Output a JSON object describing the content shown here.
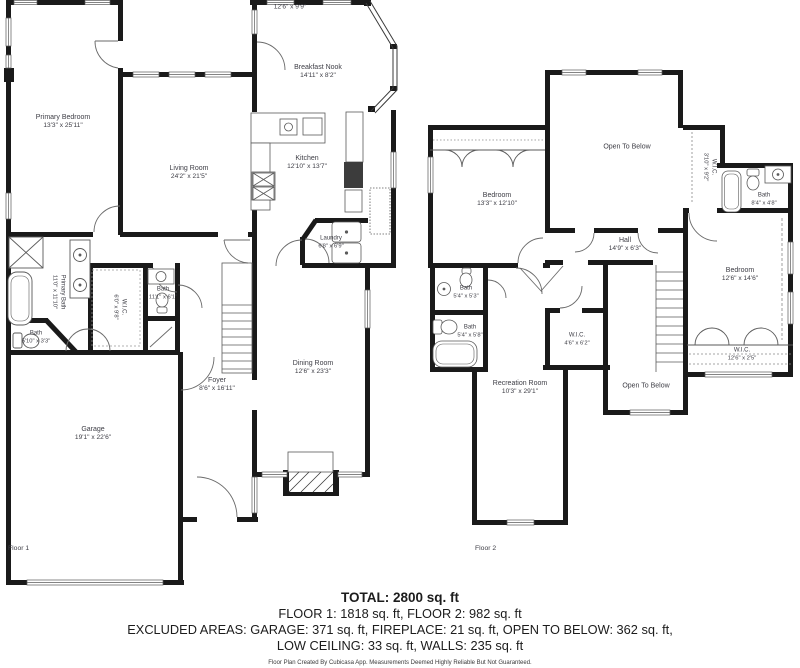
{
  "colors": {
    "wall": "#1a1a1a",
    "thin": "#5a5a5a",
    "label_text": "#3d3d45"
  },
  "floor1": {
    "label": "Floor 1",
    "rooms": [
      {
        "id": "unnamed-top",
        "name": "",
        "dims": "12'6\" x 9'9\""
      },
      {
        "id": "primary-bedroom",
        "name": "Primary Bedroom",
        "dims": "13'3\" x 25'11\""
      },
      {
        "id": "living-room",
        "name": "Living Room",
        "dims": "24'2\" x 21'5\""
      },
      {
        "id": "breakfast-nook",
        "name": "Breakfast Nook",
        "dims": "14'11\" x 8'2\""
      },
      {
        "id": "kitchen",
        "name": "Kitchen",
        "dims": "12'10\" x 13'7\""
      },
      {
        "id": "laundry",
        "name": "Laundry",
        "dims": "6'8\" x 6'9\""
      },
      {
        "id": "primary-bath",
        "name": "Primary Bath",
        "dims": "11'0\" x 11'10\""
      },
      {
        "id": "wic",
        "name": "W.I.C.",
        "dims": "6'0\" x 9'8\""
      },
      {
        "id": "bath-center",
        "name": "Bath",
        "dims": "11'1\" x 6'1\""
      },
      {
        "id": "bath-small",
        "name": "Bath",
        "dims": "5'10\" x 3'3\""
      },
      {
        "id": "foyer",
        "name": "Foyer",
        "dims": "8'6\" x 16'11\""
      },
      {
        "id": "garage",
        "name": "Garage",
        "dims": "19'1\" x 22'6\""
      },
      {
        "id": "dining-room",
        "name": "Dining Room",
        "dims": "12'6\" x 23'3\""
      }
    ]
  },
  "floor2": {
    "label": "Floor 2",
    "rooms": [
      {
        "id": "open-to-below-top",
        "name": "Open To Below",
        "dims": ""
      },
      {
        "id": "bedroom-1",
        "name": "Bedroom",
        "dims": "13'3\" x 12'10\""
      },
      {
        "id": "wic-1",
        "name": "W.I.C.",
        "dims": "3'10\" x 9'2\""
      },
      {
        "id": "bath-1",
        "name": "Bath",
        "dims": "8'4\" x 4'8\""
      },
      {
        "id": "hall",
        "name": "Hall",
        "dims": "14'9\" x 6'3\""
      },
      {
        "id": "bedroom-2",
        "name": "Bedroom",
        "dims": "12'6\" x 14'6\""
      },
      {
        "id": "bath-2",
        "name": "Bath",
        "dims": "5'4\" x 5'3\""
      },
      {
        "id": "bath-3",
        "name": "Bath",
        "dims": "5'4\" x 5'8\""
      },
      {
        "id": "wic-2",
        "name": "W.I.C.",
        "dims": "4'6\" x 6'2\""
      },
      {
        "id": "recreation-room",
        "name": "Recreation Room",
        "dims": "10'3\" x 29'1\""
      },
      {
        "id": "open-to-below-bottom",
        "name": "Open To Below",
        "dims": ""
      },
      {
        "id": "wic-3",
        "name": "W.I.C.",
        "dims": "12'6\" x 2'5\""
      }
    ]
  },
  "summary": {
    "total": "TOTAL: 2800 sq. ft",
    "floors": "FLOOR 1: 1818 sq. ft, FLOOR 2: 982 sq. ft",
    "excluded_1": "EXCLUDED AREAS: GARAGE: 371 sq. ft, FIREPLACE: 21 sq. ft, OPEN TO BELOW: 362 sq. ft,",
    "excluded_2": "LOW CEILING: 33 sq. ft, WALLS: 235 sq. ft",
    "disclaimer": "Floor Plan Created By Cubicasa App. Measurements Deemed Highly Reliable But Not Guaranteed."
  }
}
